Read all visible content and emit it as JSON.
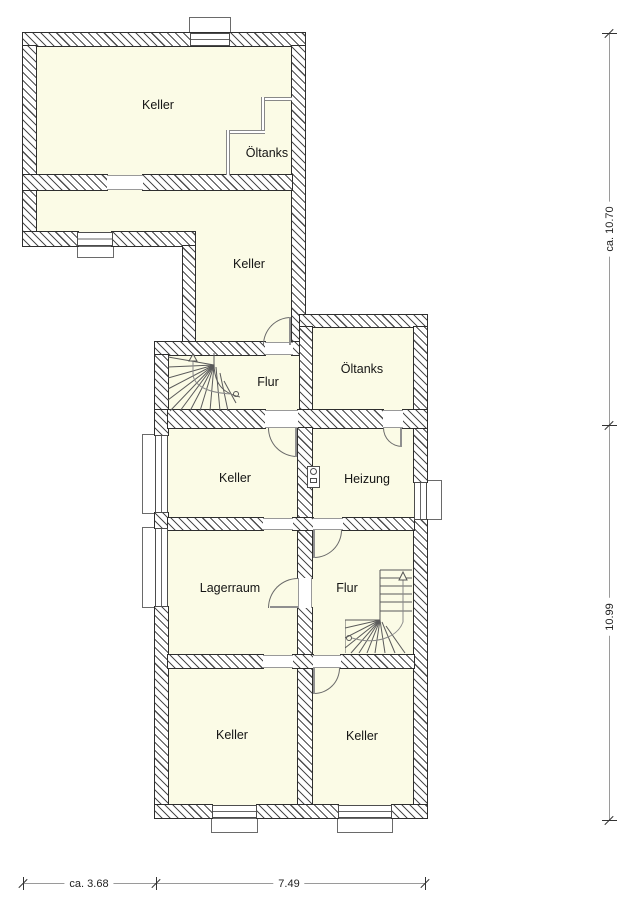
{
  "plan": {
    "title": "Kellergeschoss Grundriss",
    "rooms": [
      {
        "id": "keller-main",
        "label": "Keller"
      },
      {
        "id": "oeltanks-upper",
        "label": "Öltanks"
      },
      {
        "id": "keller-hall",
        "label": "Keller"
      },
      {
        "id": "flur-upper",
        "label": "Flur"
      },
      {
        "id": "oeltanks-lower",
        "label": "Öltanks"
      },
      {
        "id": "keller-mid",
        "label": "Keller"
      },
      {
        "id": "heizung",
        "label": "Heizung"
      },
      {
        "id": "lagerraum",
        "label": "Lagerraum"
      },
      {
        "id": "flur-lower",
        "label": "Flur"
      },
      {
        "id": "keller-bottom-left",
        "label": "Keller"
      },
      {
        "id": "keller-bottom-right",
        "label": "Keller"
      }
    ],
    "dimensions": {
      "right_top": "ca. 10.70",
      "right_bottom": "10.99",
      "bottom_left": "ca. 3.68",
      "bottom_mid": "7.49"
    },
    "colors": {
      "room_fill": "#fbfbe6",
      "wall_line": "#2e2e2e",
      "hatch": "#4d4d4d",
      "dim_line": "#9a9a9a"
    }
  }
}
